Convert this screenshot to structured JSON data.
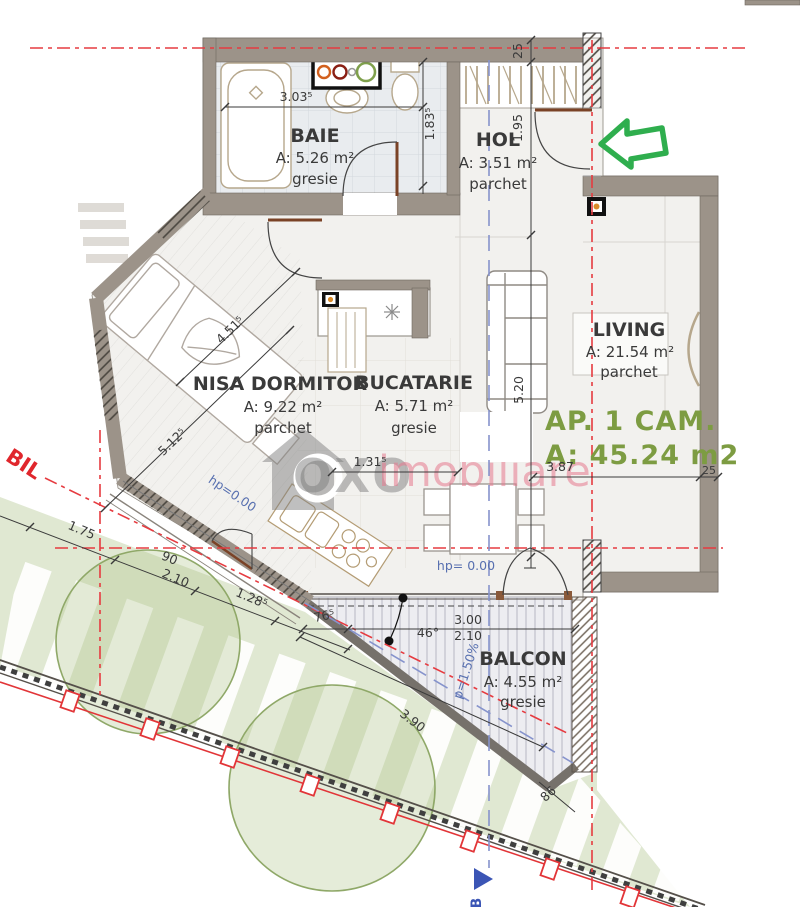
{
  "plan": {
    "watermark": {
      "brand": "OXO",
      "suffix": "imobiliare"
    },
    "apartment": {
      "title": "AP. 1 CAM.",
      "area": "A: 45.24 m2"
    },
    "rooms": {
      "baie": {
        "name": "BAIE",
        "area": "A: 5.26 m²",
        "floor": "gresie"
      },
      "hol": {
        "name": "HOL",
        "area": "A: 3.51 m²",
        "floor": "parchet"
      },
      "dormitor": {
        "name": "NISA DORMITOR",
        "area": "A: 9.22 m²",
        "floor": "parchet"
      },
      "bucatarie": {
        "name": "BUCATARIE",
        "area": "A: 5.71 m²",
        "floor": "gresie"
      },
      "living": {
        "name": "LIVING",
        "area": "A: 21.54 m²",
        "floor": "parchet"
      },
      "balcon": {
        "name": "BALCON",
        "area": "A: 4.55 m²",
        "floor": "gresie"
      }
    },
    "dimensions": {
      "baie_width": "3.03⁵",
      "baie_depth": "1.83⁵",
      "wall_top": "25",
      "hol_depth": "1.95",
      "living_depth": "5.20",
      "living_width": "3.87",
      "wall_right": "25",
      "dormitor_width": "4.51⁵",
      "dormitor_length": "5.12⁵",
      "bucatarie_width": "1.31⁵",
      "terrace_1": "1.75",
      "terrace_2": "90",
      "terrace_3": "2.10",
      "terrace_4": "1.28⁵",
      "balcon_1": "76⁵",
      "balcon_angle": "46°",
      "balcon_2": "3.00",
      "balcon_3": "2.10",
      "balcon_4": "3.90",
      "balcon_5": "86"
    },
    "annotations": {
      "hp_hol": "hp= 0.00",
      "hp_dormitor": "hp=0.00",
      "slope": "p=1.50%",
      "section_mark": "B",
      "axis_label": "BIL"
    },
    "colors": {
      "apartment_label_green": "#7d9c42",
      "entrance_arrow_green": "#2fae4e",
      "axis_red": "#e63b40",
      "section_blue": "#3b55b5",
      "watermark_pink": "#e67c8e"
    }
  }
}
